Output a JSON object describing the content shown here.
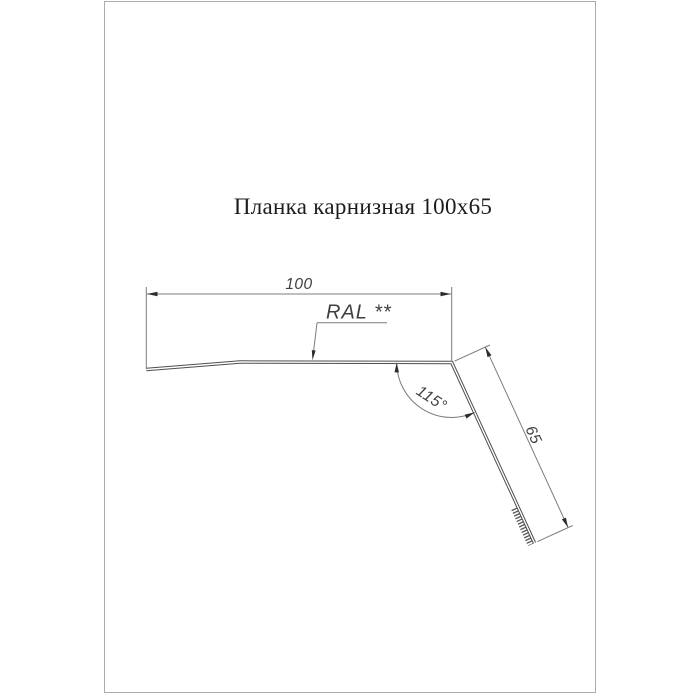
{
  "sheet": {
    "title": "Планка карнизная 100x65"
  },
  "drawing": {
    "labels": {
      "width": "100",
      "length": "65",
      "angle": "115°",
      "coating": "RAL **"
    },
    "colors": {
      "profile_line": "#4e4e4e",
      "dimension_line": "#7c7c7c",
      "text": "#3f3f3f",
      "sheet_border": "#acacac",
      "background": "#ffffff"
    }
  }
}
